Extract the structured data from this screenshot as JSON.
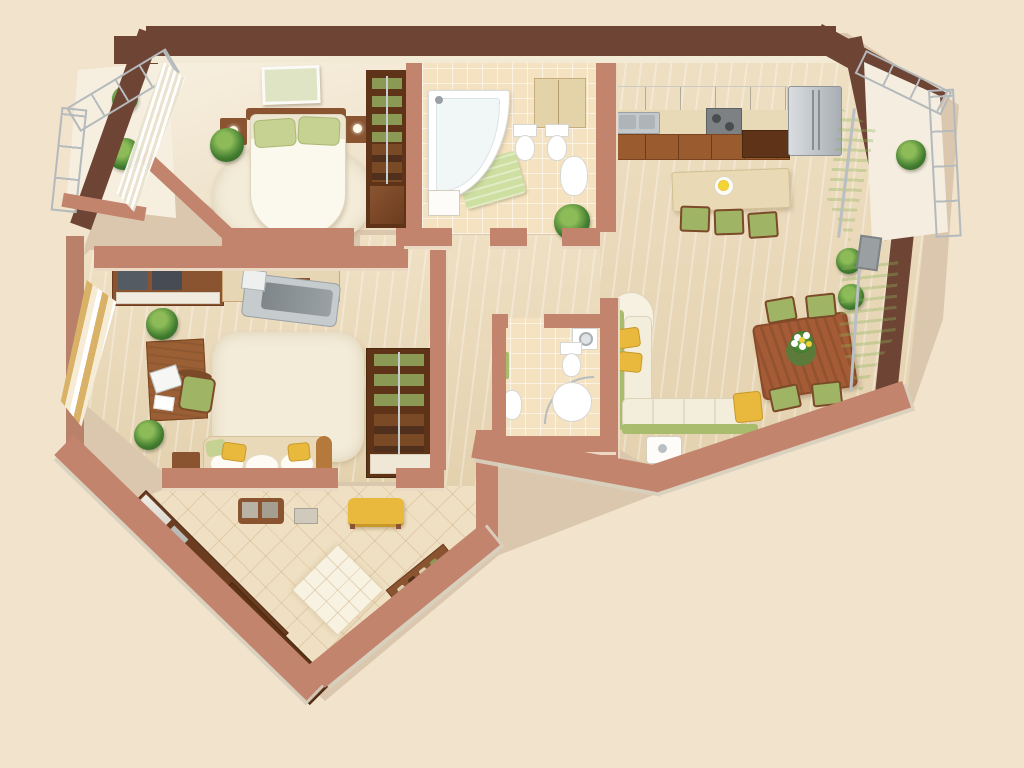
{
  "scene": {
    "title": "3D apartment floor plan (top-down render)",
    "background": "#f1e3cc",
    "palette": {
      "background": "#f1e3cc",
      "wall_outer_dark": "#6e4434",
      "wall_inner": "#c2846c",
      "wall_face": "#f3ead6",
      "floor_wood": "#e9d8ba",
      "floor_tile": "#f4e2c0",
      "carpet": "#f3ecd9",
      "furniture_wood": "#8a5431",
      "furniture_wood_dark": "#5e3318",
      "accent_green": "#a9bb6c",
      "accent_yellow": "#e9b93d",
      "pillow_green": "#c6d292",
      "curtain_green": "#cfe3a8",
      "curtain_gold": "#d9b268",
      "plant_green": "#2c5a20",
      "glass": "#e7edef",
      "metal": "#b4babc"
    },
    "rooms": [
      {
        "id": "bedroom",
        "name": "Bedroom",
        "furniture": [
          "double-bed",
          "green-pillows",
          "nightstands",
          "wall-picture",
          "shelved-wardrobe",
          "rug",
          "sheer-curtain",
          "plant"
        ]
      },
      {
        "id": "main-bathroom",
        "name": "Main bathroom",
        "furniture": [
          "corner-bathtub",
          "toilet",
          "bidet",
          "washbasin",
          "vanity-cabinet",
          "green-bath-mat"
        ]
      },
      {
        "id": "kitchen-dining-living",
        "name": "Kitchen / dining / living room",
        "furniture": [
          "kitchen-counter",
          "upper-cabinets",
          "sink",
          "stove",
          "refrigerator",
          "bar-table",
          "bar-chairs",
          "flower-plate",
          "dining-table",
          "dining-chairs",
          "flower-centerpiece",
          "corner-sofa",
          "yellow-pillows",
          "side-table",
          "green-window-curtains",
          "plants"
        ]
      },
      {
        "id": "study-lounge",
        "name": "Study / lounge",
        "furniture": [
          "wall-unit",
          "treadmill",
          "desk",
          "laptop",
          "desk-chair",
          "rug",
          "sofa",
          "seat-cushions",
          "pillows",
          "side-table",
          "shelved-cabinet",
          "gold-curtain",
          "plants"
        ]
      },
      {
        "id": "small-bathroom",
        "name": "Small bathroom",
        "furniture": [
          "toilet",
          "corner-shower",
          "washbasin",
          "washing-machine",
          "towel"
        ]
      },
      {
        "id": "entrance-hall",
        "name": "Entrance hall",
        "furniture": [
          "built-in-wardrobe",
          "open-shelving",
          "yellow-bench",
          "ottoman",
          "console",
          "shoe-shelf",
          "floor-mat"
        ]
      },
      {
        "id": "balcony-left",
        "name": "Glazed balcony (left)",
        "furniture": [
          "glazing",
          "plants"
        ]
      },
      {
        "id": "balcony-right",
        "name": "Glazed balcony (right)",
        "furniture": [
          "glazing",
          "plant"
        ]
      },
      {
        "id": "corridor",
        "name": "Corridor",
        "furniture": [
          "potted-plant"
        ]
      }
    ]
  }
}
